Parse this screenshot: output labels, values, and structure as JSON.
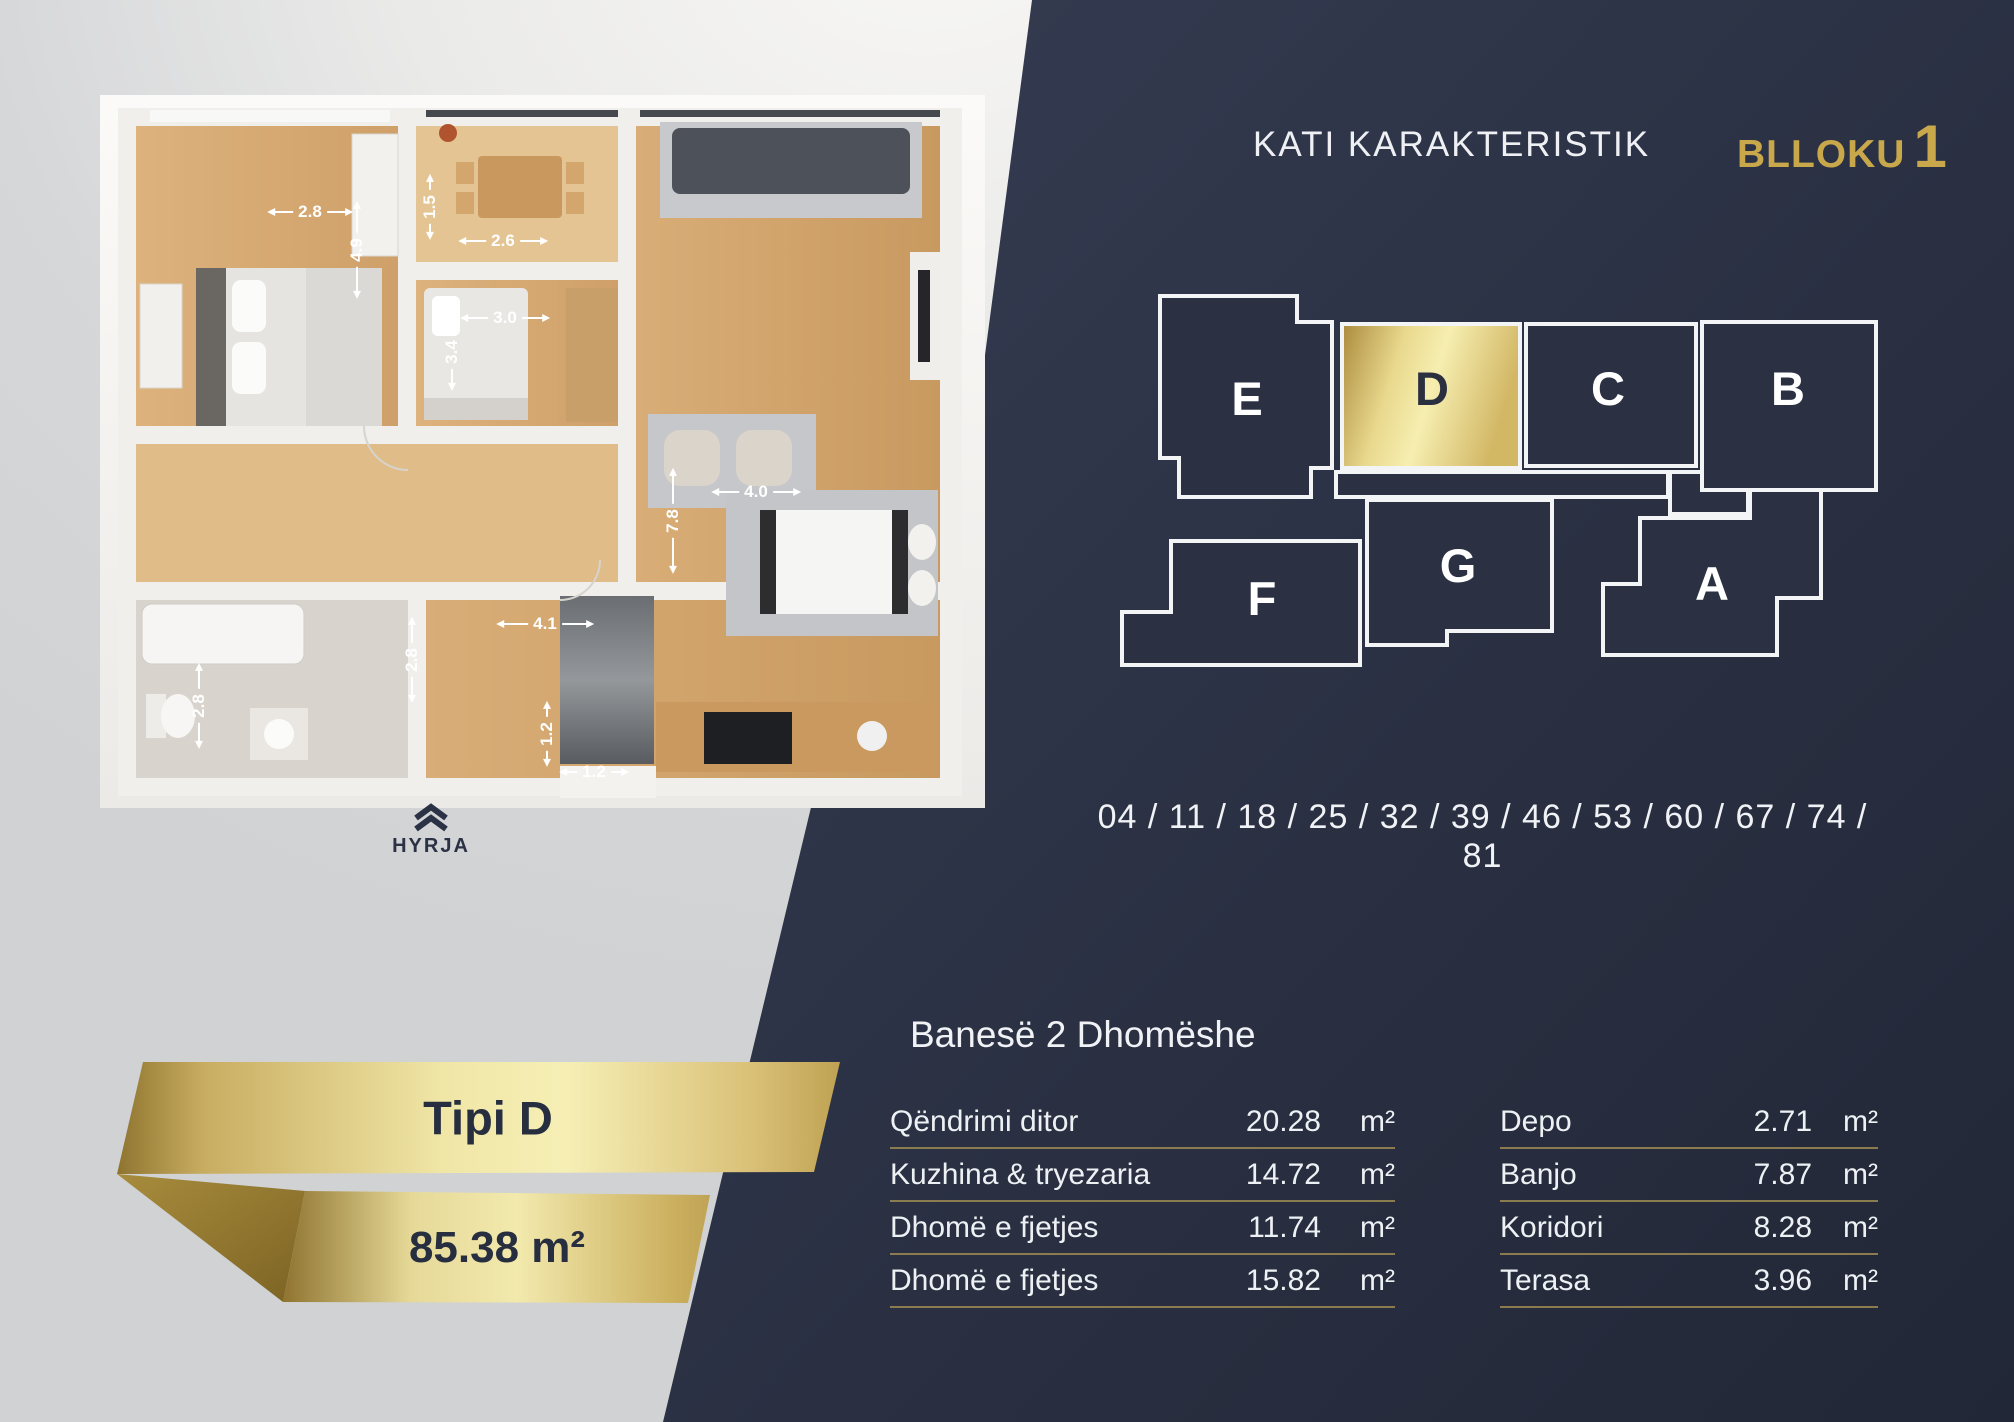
{
  "header": {
    "title": "KATI KARAKTERISTIK",
    "block_label": "BLLOKU",
    "block_number": "1"
  },
  "diagram": {
    "units": [
      {
        "id": "e",
        "label": "E",
        "highlighted": false
      },
      {
        "id": "d",
        "label": "D",
        "highlighted": true
      },
      {
        "id": "c",
        "label": "C",
        "highlighted": false
      },
      {
        "id": "b",
        "label": "B",
        "highlighted": false
      },
      {
        "id": "f",
        "label": "F",
        "highlighted": false
      },
      {
        "id": "g",
        "label": "G",
        "highlighted": false
      },
      {
        "id": "a",
        "label": "A",
        "highlighted": false
      }
    ]
  },
  "units_row": {
    "text": "04 / 11 / 18 / 25 / 32 / 39 / 46 / 53 / 60 / 67 / 74 / 81"
  },
  "apartment": {
    "heading": "Banesë 2 Dhomëshe",
    "tables": [
      {
        "rows": [
          {
            "label": "Qëndrimi ditor",
            "value": "20.28",
            "unit": "m²"
          },
          {
            "label": "Kuzhina & tryezaria",
            "value": "14.72",
            "unit": "m²"
          },
          {
            "label": "Dhomë e fjetjes",
            "value": "11.74",
            "unit": "m²"
          },
          {
            "label": "Dhomë e fjetjes",
            "value": "15.82",
            "unit": "m²"
          }
        ]
      },
      {
        "rows": [
          {
            "label": "Depo",
            "value": "2.71",
            "unit": "m²"
          },
          {
            "label": "Banjo",
            "value": "7.87",
            "unit": "m²"
          },
          {
            "label": "Koridori",
            "value": "8.28",
            "unit": "m²"
          },
          {
            "label": "Terasa",
            "value": "3.96",
            "unit": "m²"
          }
        ]
      }
    ]
  },
  "ribbon": {
    "type_label": "Tipi D",
    "total_area": "85.38 m²"
  },
  "plan": {
    "entrance_label": "HYRJA",
    "dimensions": [
      {
        "value": "2.8",
        "orient": "h",
        "x": 310,
        "y": 212,
        "len": 24
      },
      {
        "value": "4.9",
        "orient": "v",
        "x": 357,
        "y": 250,
        "len": 30
      },
      {
        "value": "1.5",
        "orient": "v",
        "x": 430,
        "y": 207,
        "len": 14
      },
      {
        "value": "2.6",
        "orient": "h",
        "x": 503,
        "y": 241,
        "len": 26
      },
      {
        "value": "3.0",
        "orient": "h",
        "x": 505,
        "y": 318,
        "len": 26
      },
      {
        "value": "3.4",
        "orient": "v",
        "x": 452,
        "y": 352,
        "len": 20
      },
      {
        "value": "4.0",
        "orient": "h",
        "x": 756,
        "y": 492,
        "len": 26
      },
      {
        "value": "7.8",
        "orient": "v",
        "x": 673,
        "y": 521,
        "len": 34
      },
      {
        "value": "4.1",
        "orient": "h",
        "x": 545,
        "y": 624,
        "len": 30
      },
      {
        "value": "2.8",
        "orient": "v",
        "x": 412,
        "y": 660,
        "len": 24
      },
      {
        "value": "2.8",
        "orient": "v",
        "x": 199,
        "y": 706,
        "len": 24
      },
      {
        "value": "1.2",
        "orient": "v",
        "x": 547,
        "y": 734,
        "len": 14
      },
      {
        "value": "1.2",
        "orient": "h",
        "x": 594,
        "y": 772,
        "len": 16
      }
    ]
  },
  "colors": {
    "navy": "#2b3143",
    "gold": "#c9a84c",
    "gold_light": "#f4ecae",
    "divider": "#8a7c4f",
    "text_light": "#eef0f4"
  }
}
